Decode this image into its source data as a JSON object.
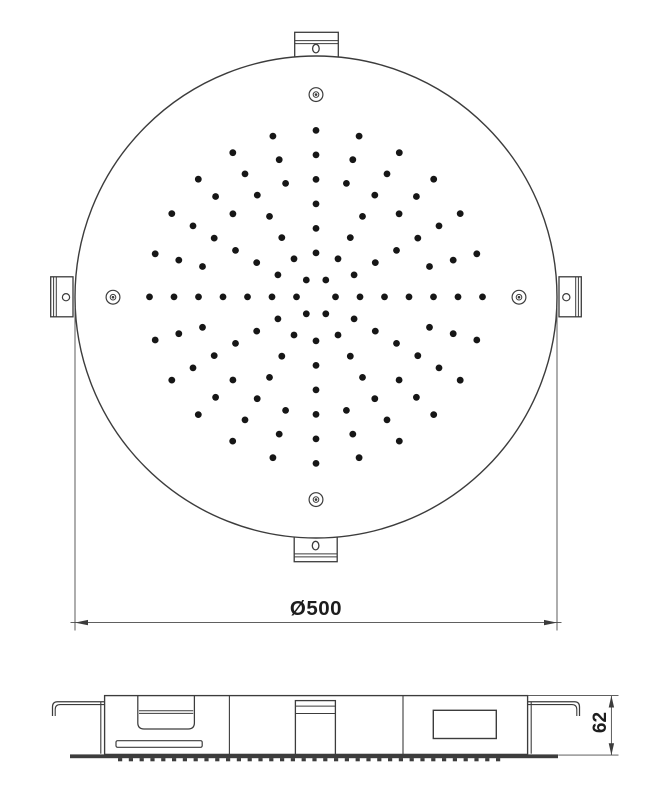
{
  "drawing": {
    "kind": "shower-head-technical-drawing",
    "dimension_labels": {
      "diameter": "Ø500",
      "height": "62"
    }
  },
  "colors": {
    "line": "#3c3c3c",
    "dot": "#161616",
    "base_plate": "#3d3d3d",
    "background": "#ffffff",
    "text": "#1d1d1d"
  },
  "nozzle_pattern": {
    "center": {
      "x": 316,
      "y": 296.9
    },
    "dot_radius": 3.4,
    "rings": [
      {
        "radius": 19.5,
        "count": 6,
        "start_angle_deg": 0
      },
      {
        "radius": 44,
        "count": 12,
        "start_angle_deg": 0
      },
      {
        "radius": 68.5,
        "count": 12,
        "start_angle_deg": 0
      },
      {
        "radius": 93,
        "count": 12,
        "start_angle_deg": 0
      },
      {
        "radius": 117.5,
        "count": 24,
        "start_angle_deg": 0
      },
      {
        "radius": 142,
        "count": 24,
        "start_angle_deg": 0
      },
      {
        "radius": 166.5,
        "count": 24,
        "start_angle_deg": 0
      }
    ]
  },
  "nozzle_strip": {
    "x_start": 118,
    "spacing": 10.8,
    "count": 36,
    "width": 4.2,
    "height": 3.2,
    "y": 758.1
  }
}
